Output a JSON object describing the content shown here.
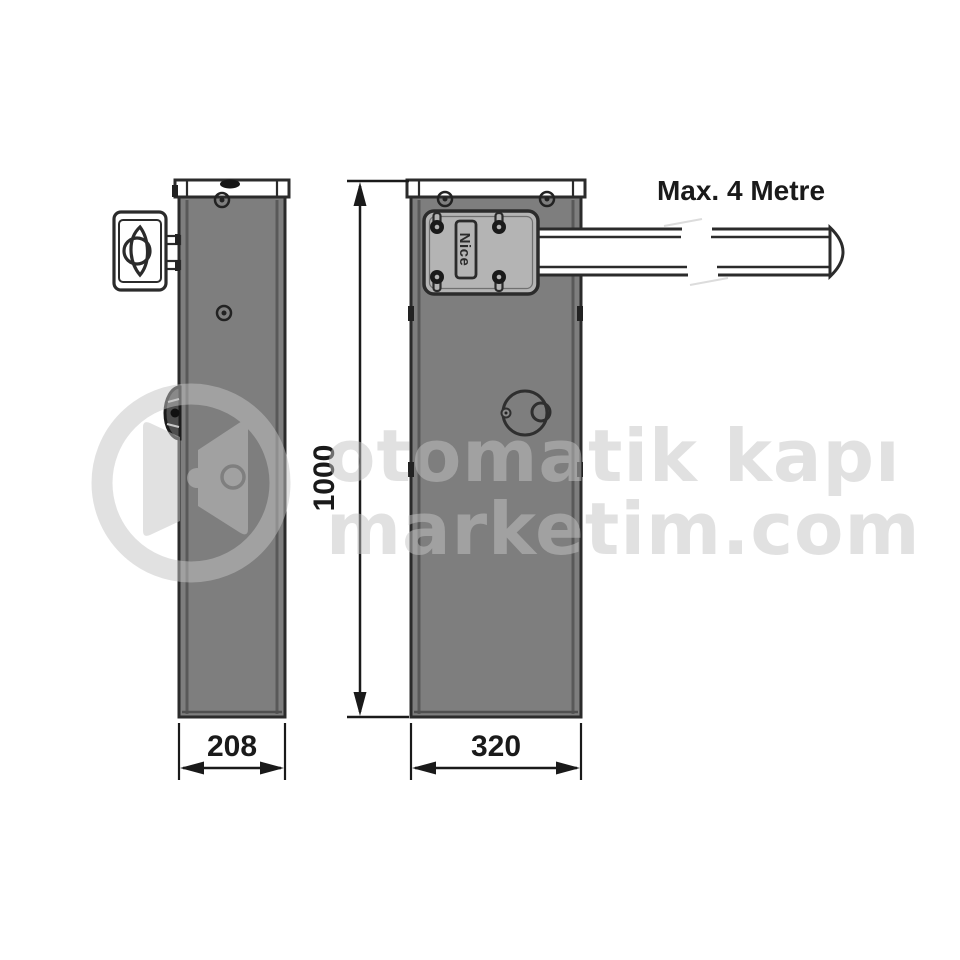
{
  "diagram": {
    "type": "technical-dimension-drawing",
    "subject": "barrier gate cabinet with boom arm, side and front views"
  },
  "labels": {
    "arm_max_length": "Max. 4 Metre",
    "height_mm": "1000",
    "side_width_mm": "208",
    "front_width_mm": "320",
    "brand": "Nice"
  },
  "dimensions_data": {
    "cabinet_height": 1000,
    "cabinet_depth_side_view": 208,
    "cabinet_width_front_view": 320,
    "arm_max_length_metres": 4
  },
  "watermark": {
    "line1": "otomatik kapı",
    "line2": "marketim.com"
  },
  "colors": {
    "outline": "#2b2b2b",
    "cabinet_fill": "#7e7e7e",
    "plate_fill": "#b4b4b4",
    "cap_fill": "#ffffff",
    "text": "#1a1a1a",
    "watermark": "#c4c4c4",
    "background": "#ffffff"
  }
}
